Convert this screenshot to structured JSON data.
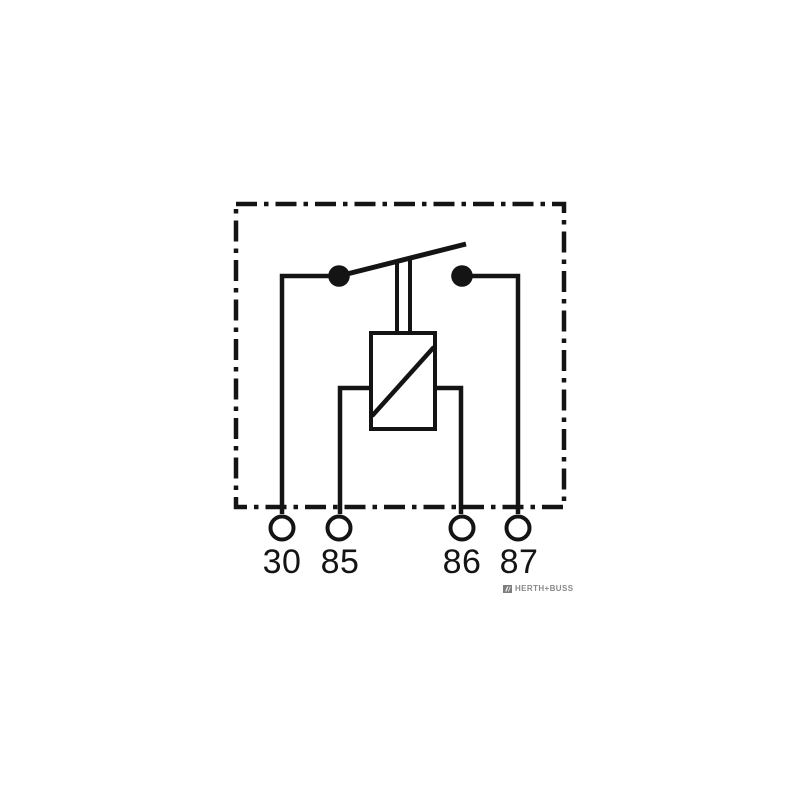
{
  "diagram": {
    "type": "relay-circuit-schematic",
    "terminals": [
      {
        "label": "30"
      },
      {
        "label": "85"
      },
      {
        "label": "86"
      },
      {
        "label": "87"
      }
    ],
    "components": {
      "enclosure": "dash-dot boundary box",
      "switch": "normally-open contact between 30 and 87",
      "coil": "relay coil between 85 and 86"
    }
  },
  "watermark": {
    "brand": "HERTH+BUSS"
  },
  "colors": {
    "line": "#141414",
    "background": "#ffffff",
    "watermark_text": "#8a8a8a",
    "watermark_logo": "#7d7d7d"
  }
}
